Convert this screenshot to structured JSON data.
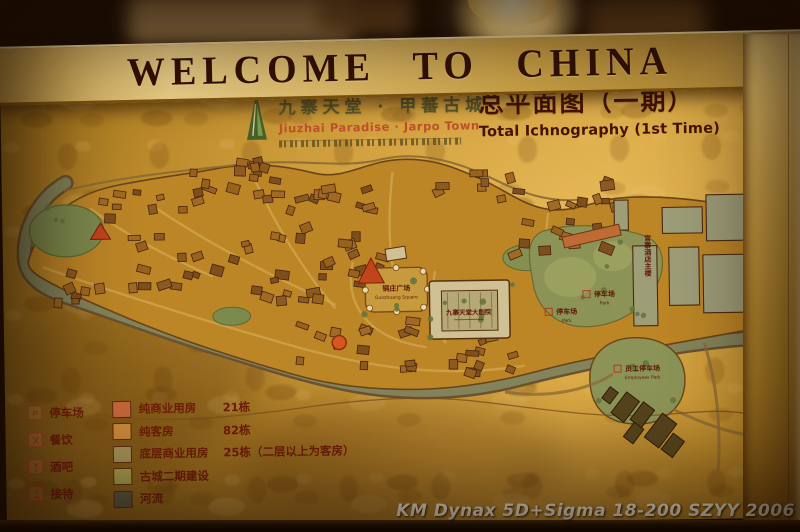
{
  "banner": {
    "text": "WELCOME TO CHINA"
  },
  "board_header": {
    "logo_icon": "green-peak-logo",
    "title_cn": "九寨天堂 · 甲蕃古城",
    "title_en": "Jiuzhai Paradise · Jarpo Town",
    "plan_title_cn": "总平面图（一期）",
    "plan_title_en": "Total Ichnography (1st Time)"
  },
  "map_labels": [
    {
      "name": "guozhuang-square",
      "cn": "锅庄广场",
      "en": "Guozhuang Square",
      "x": 393,
      "y": 149,
      "size": 7
    },
    {
      "name": "grand-theatre",
      "cn": "九寨天堂大剧院",
      "en": "",
      "x": 465,
      "y": 174,
      "size": 6.5
    },
    {
      "name": "parking-upper",
      "cn": "停车场",
      "en": "Park",
      "x": 601,
      "y": 158,
      "size": 7,
      "p_icon": true
    },
    {
      "name": "parking-lower",
      "cn": "停车场",
      "en": "Park",
      "x": 563,
      "y": 175,
      "size": 7,
      "p_icon": true
    },
    {
      "name": "employees-parking",
      "cn": "员工停车场",
      "en": "Employees Park",
      "x": 638,
      "y": 233,
      "size": 7,
      "p_icon": true
    },
    {
      "name": "hotel-main-building",
      "cn": "官寨酒店主楼",
      "en": "",
      "x": 645,
      "y": 118,
      "size": 7,
      "vertical": true
    }
  ],
  "legend": {
    "poi_items": [
      {
        "icon": "parking-icon",
        "label": "停车场"
      },
      {
        "icon": "dining-icon",
        "label": "餐饮"
      },
      {
        "icon": "bar-icon",
        "label": "酒吧"
      },
      {
        "icon": "reception-icon",
        "label": "接待"
      }
    ],
    "category_items": [
      {
        "color": "#c4663a",
        "label": "纯商业用房",
        "count": "21栋"
      },
      {
        "color": "#c8883a",
        "label": "纯客房",
        "count": "82栋"
      },
      {
        "color": "#a39158",
        "label": "底层商业用房",
        "count": "25栋（二层以上为客房）"
      },
      {
        "color": "#a79d4e",
        "label": "古城二期建设",
        "count": ""
      },
      {
        "color": "#585a42",
        "label": "河流",
        "count": ""
      }
    ]
  },
  "watermark": "KM Dynax 5D+Sigma 18-200 SZYY 2006"
}
